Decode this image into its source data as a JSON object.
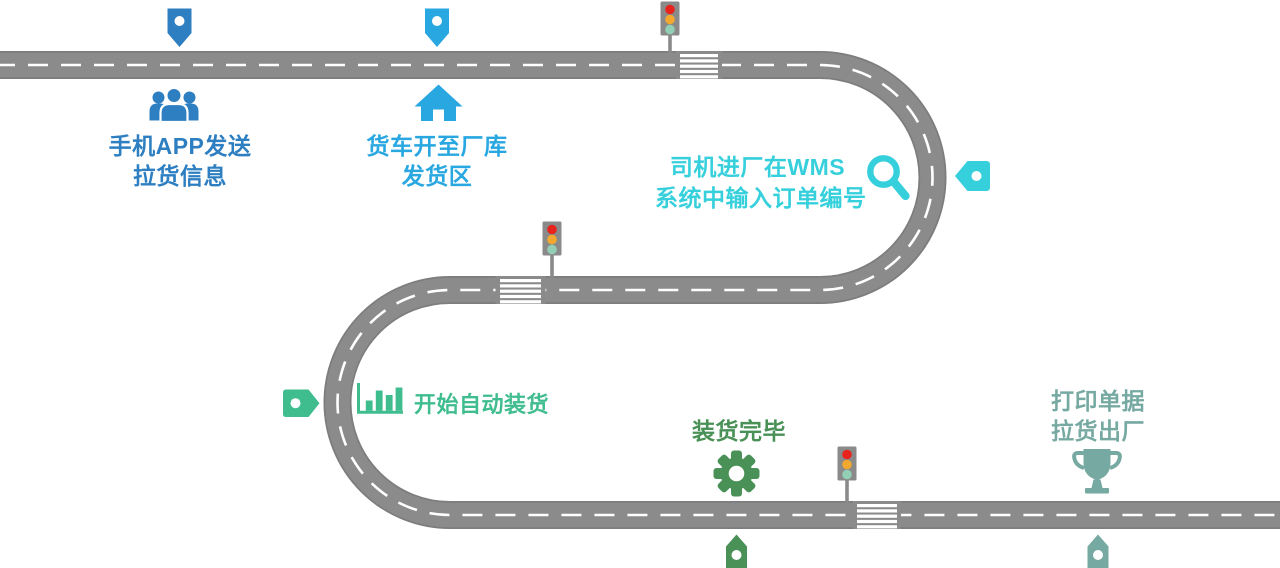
{
  "stations": [
    {
      "lines": [
        "手机APP发送",
        "拉货信息"
      ],
      "icon": "users-icon",
      "marker_icon": "pin-down-icon",
      "color": "#2e7fc1"
    },
    {
      "lines": [
        "货车开至厂库",
        "发货区"
      ],
      "icon": "home-icon",
      "marker_icon": "pin-down-icon",
      "color": "#29a7e1"
    },
    {
      "lines": [
        "司机进厂在WMS",
        "系统中输入订单编号"
      ],
      "icon": "magnifier-icon",
      "marker_icon": "tag-left-icon",
      "color": "#36d0dc"
    },
    {
      "lines": [
        "开始自动装货"
      ],
      "icon": "bar-chart-icon",
      "marker_icon": "tag-right-icon",
      "color": "#3fbd8f"
    },
    {
      "lines": [
        "装货完毕"
      ],
      "icon": "gear-icon",
      "marker_icon": "pin-up-icon",
      "color": "#4a9158"
    },
    {
      "lines": [
        "打印单据",
        "拉货出厂"
      ],
      "icon": "trophy-icon",
      "marker_icon": "pin-up-icon",
      "color": "#76a9a1"
    }
  ],
  "road": {
    "surface_color": "#8b8b8b",
    "edge_color": "#7d7d7d",
    "dash_color": "#ffffff",
    "crosswalk_stripe_color": "#ffffff"
  },
  "traffic_light": {
    "housing_color": "#8a8a8a",
    "red": "#e8231d",
    "amber": "#f2a72e",
    "green": "#92cfb4"
  },
  "marker_dot_color": "#ffffff"
}
